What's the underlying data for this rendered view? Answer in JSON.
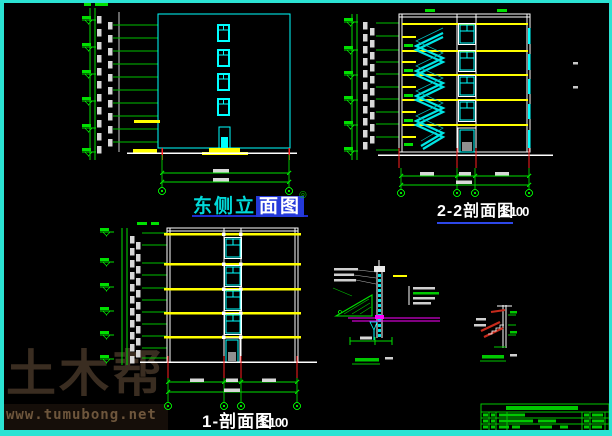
{
  "app": {
    "type": "cad-drawing-viewer"
  },
  "canvas": {
    "width": 612,
    "height": 436,
    "background": "#000000",
    "frame_color": "#2BE3D3"
  },
  "colors": {
    "line_green": "#00E000",
    "cad_cyan": "#00FFFF",
    "cad_yellow": "#FFFF00",
    "cad_white": "#FFFFFF",
    "cad_red": "#FF2020",
    "cad_magenta": "#FF00FF",
    "selection_blue": "#2439DA",
    "underline_blue": "#2D47E8",
    "titleblock_green": "#00C800",
    "watermark_brown": "#3A2D21"
  },
  "titles": {
    "east_elevation": {
      "prefix": "东侧立",
      "selected": "面图",
      "marker": "◎"
    },
    "section_2_2": {
      "label": "2-2剖面图",
      "scale": "1:100"
    },
    "section_1_1": {
      "label": "1-剖面图",
      "scale": "1:100"
    }
  },
  "drawings": [
    {
      "name": "east-elevation",
      "title": "东侧立面图"
    },
    {
      "name": "section-2-2",
      "title": "2-2剖面图 1:100"
    },
    {
      "name": "section-1-1",
      "title": "1-剖面图 1:100"
    },
    {
      "name": "eave-detail",
      "title": ""
    },
    {
      "name": "stair-detail",
      "title": ""
    },
    {
      "name": "title-block",
      "title": ""
    }
  ],
  "watermark": {
    "logo": "土木帮",
    "url": "www.tumubong.net"
  }
}
